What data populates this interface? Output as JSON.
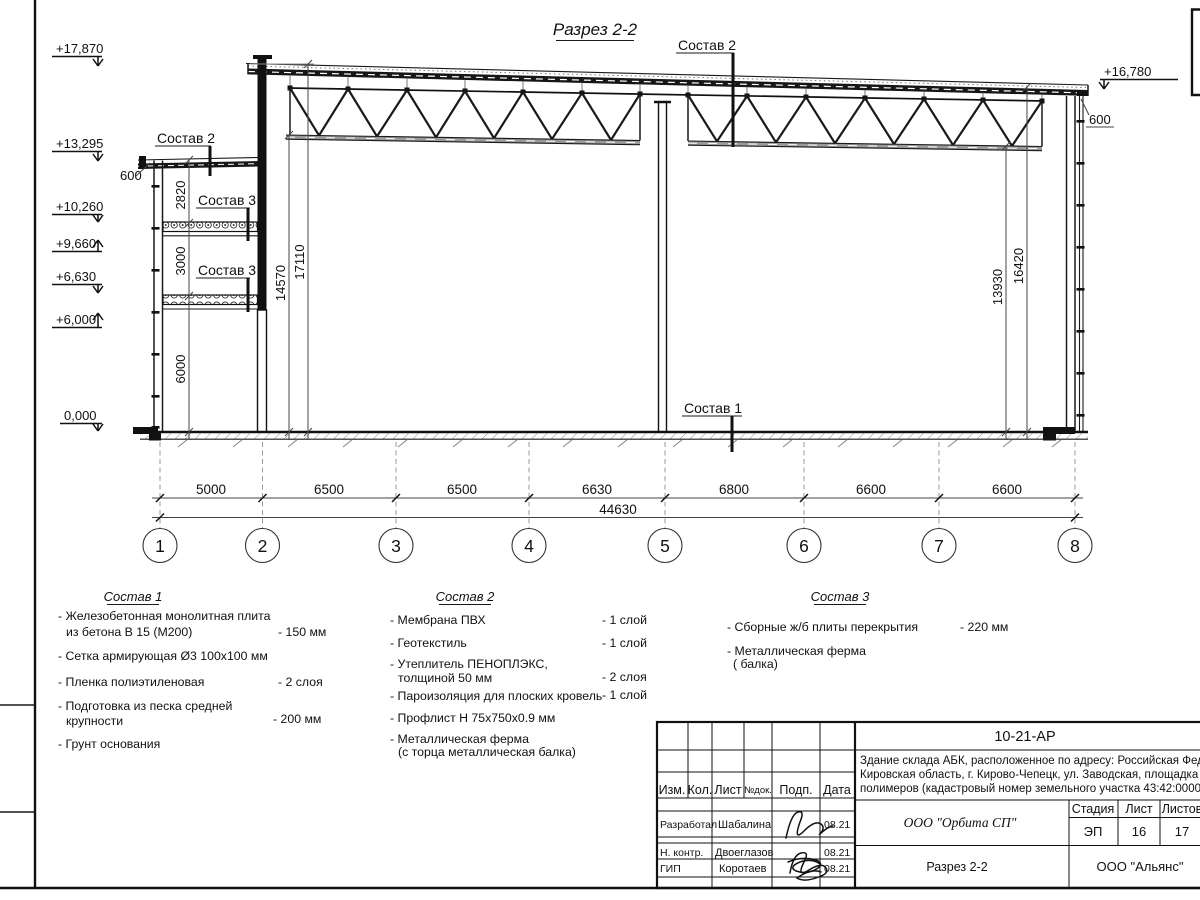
{
  "drawing": {
    "title": "Разрез 2-2",
    "callout_roof_main": "Состав 2",
    "callout_roof_annex": "Состав 2",
    "callout_slab_upper": "Состав 3",
    "callout_slab_lower": "Состав 3",
    "callout_floor": "Состав 1",
    "elevations_left": [
      {
        "value": "+17,870"
      },
      {
        "value": "+13,295"
      },
      {
        "value": "+10,260"
      },
      {
        "value": "+9,660"
      },
      {
        "value": "+6,630"
      },
      {
        "value": "+6,000"
      },
      {
        "value": "0,000"
      }
    ],
    "elevation_right": "+16,780",
    "parapet_dim_left": "600",
    "parapet_dim_right": "600",
    "annex_dims": [
      "2820",
      "3000",
      "6000"
    ],
    "hall_dims_left": [
      "14570",
      "17110"
    ],
    "hall_dims_right": [
      "13930",
      "16420"
    ],
    "span_dims": [
      "5000",
      "6500",
      "6500",
      "6630",
      "6800",
      "6600",
      "6600"
    ],
    "total_dim": "44630",
    "axes": [
      "1",
      "2",
      "3",
      "4",
      "5",
      "6",
      "7",
      "8"
    ]
  },
  "legend": {
    "sostav1": {
      "heading": "Состав 1",
      "items": [
        {
          "line1": "- Железобетонная  монолитная плита",
          "line2": "из бетона В 15 (М200)",
          "value": "- 150 мм"
        },
        {
          "line1": "- Сетка армирующая Ø3 100х100 мм",
          "line2": "",
          "value": ""
        },
        {
          "line1": "- Пленка полиэтиленовая",
          "line2": "",
          "value": "-  2 слоя"
        },
        {
          "line1": "- Подготовка из песка средней",
          "line2": "крупности",
          "value": "- 200 мм"
        },
        {
          "line1": "- Грунт основания",
          "line2": "",
          "value": ""
        }
      ]
    },
    "sostav2": {
      "heading": "Состав 2",
      "items": [
        {
          "line1": "- Мембрана ПВХ",
          "line2": "",
          "value": "- 1 слой"
        },
        {
          "line1": "- Геотекстиль",
          "line2": "",
          "value": "- 1 слой"
        },
        {
          "line1": "- Утеплитель ПЕНОПЛЭКС,",
          "line2": "толщиной 50 мм",
          "value": "- 2 слоя"
        },
        {
          "line1": "- Пароизоляция для плоских кровель",
          "line2": "",
          "value": "- 1 слой"
        },
        {
          "line1": "- Профлист Н 75х750х0.9 мм",
          "line2": "",
          "value": ""
        },
        {
          "line1": "- Металлическая ферма",
          "line2": "(с торца металлическая балка)",
          "value": ""
        }
      ]
    },
    "sostav3": {
      "heading": "Состав 3",
      "items": [
        {
          "line1": "- Сборные ж/б плиты перекрытия",
          "line2": "",
          "value": "- 220 мм"
        },
        {
          "line1": "- Металлическая ферма",
          "line2": "( балка)",
          "value": ""
        }
      ]
    }
  },
  "title_block": {
    "code": "10-21-АР",
    "object_line1": "Здание склада АБК, расположенное по адресу: Российская Федера",
    "object_line2": "Кировская область, г. Кирово-Чепецк, ул. Заводская, площадка заво",
    "object_line3": "полимеров (кадастровый номер земельного участка 43:42:000022:",
    "columns": [
      "Изм.",
      "Кол.",
      "Лист",
      "№док.",
      "Подп.",
      "Дата"
    ],
    "rows": [
      {
        "role": "Разработал",
        "name": "Шабалина",
        "date": "08.21"
      },
      {
        "role": "Н. контр.",
        "name": "Двоеглазов",
        "date": "08.21"
      },
      {
        "role": "ГИП",
        "name": "Коротаев",
        "date": "08.21"
      }
    ],
    "company": "ООО \"Орбита СП\"",
    "stage_label": "Стадия",
    "sheet_label": "Лист",
    "sheets_label": "Листов",
    "stage_value": "ЭП",
    "sheet_value": "16",
    "sheets_value": "17",
    "section_name": "Разрез 2-2",
    "contractor": "ООО \"Альянс\""
  }
}
